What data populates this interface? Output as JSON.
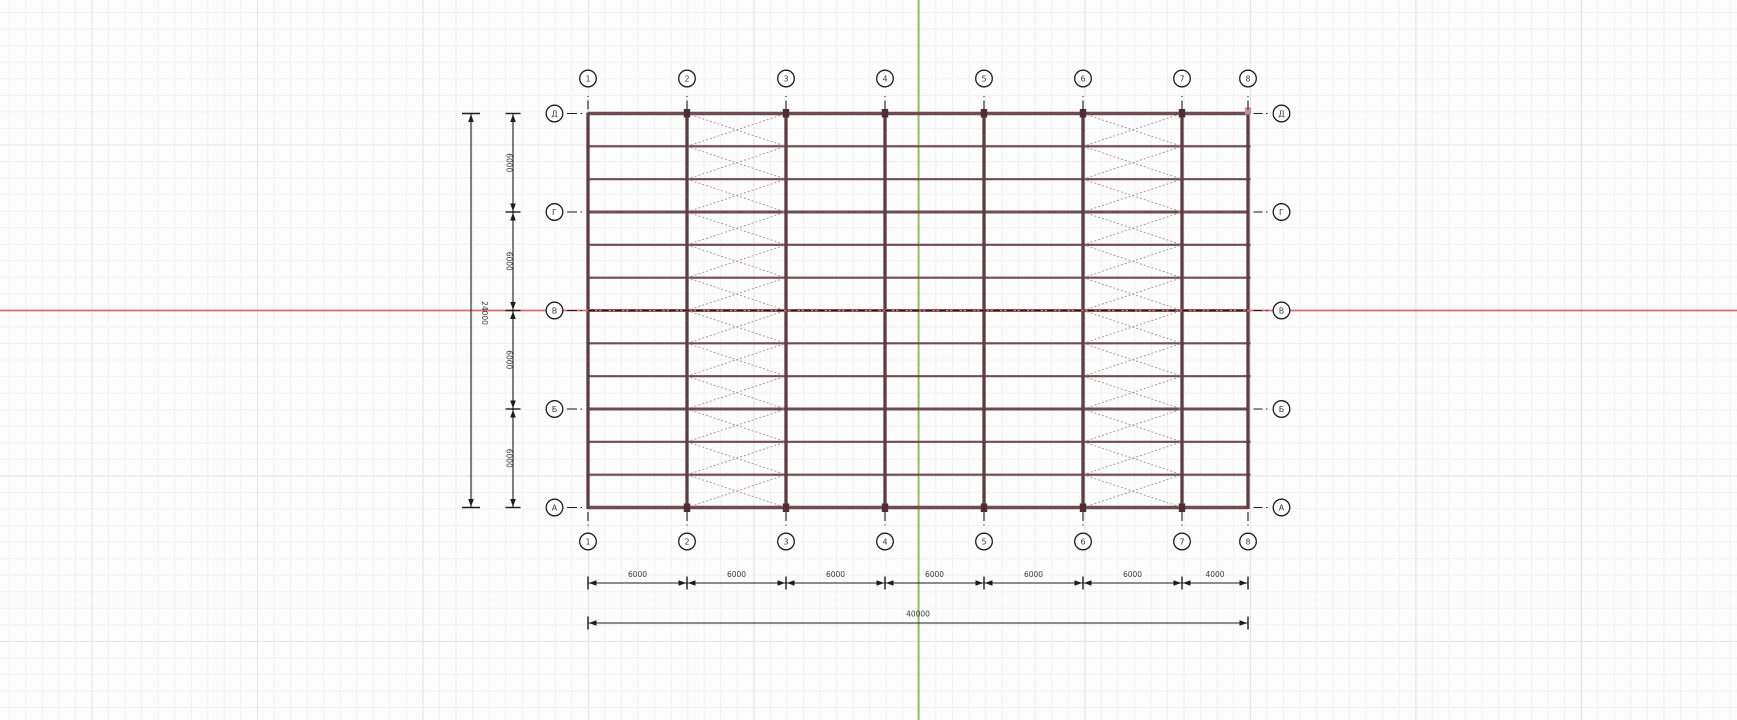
{
  "app": {
    "type": "cad-model-view",
    "description": "Structural steel frame plan view with grid axes and dimensions"
  },
  "canvas": {
    "width": 1737,
    "height": 720,
    "bg_color": "#fcfcfc",
    "grid_minor_color": "#f0f0f1",
    "grid_major_color": "#e4e4e6",
    "grid_minor_step": 16.55,
    "grid_major_step": 165.5,
    "grid_major_offset_x": 91.5,
    "grid_major_offset_y": 144.5
  },
  "construction_lines": {
    "x_axis": {
      "color": "#d96b74",
      "y": 310.5
    },
    "y_axis": {
      "color": "#95b963",
      "x": 918.5
    }
  },
  "structure": {
    "colors": {
      "purlin": "#6e4c52",
      "column": "#5d3d44",
      "marker": "#4c2f36",
      "marker_light": "#c09399",
      "brace": "#ab8c90",
      "grid_highlight": "#1c1c1c"
    },
    "left": 588,
    "right": 1248,
    "top": 113.5,
    "bottom": 507.5,
    "purlin_divisions": 12,
    "grids_x": [
      {
        "label": "1",
        "x": 588
      },
      {
        "label": "2",
        "x": 687
      },
      {
        "label": "3",
        "x": 786
      },
      {
        "label": "4",
        "x": 885
      },
      {
        "label": "5",
        "x": 984
      },
      {
        "label": "6",
        "x": 1083
      },
      {
        "label": "7",
        "x": 1182
      },
      {
        "label": "8",
        "x": 1248
      }
    ],
    "grids_y": [
      {
        "label": "Д",
        "name": "D",
        "y": 113.5
      },
      {
        "label": "Г",
        "name": "G",
        "y": 212
      },
      {
        "label": "В",
        "name": "V",
        "y": 310.5
      },
      {
        "label": "Б",
        "name": "B",
        "y": 409
      },
      {
        "label": "А",
        "name": "A",
        "y": 507.5
      }
    ],
    "braced_bays": [
      [
        "2",
        "3"
      ],
      [
        "6",
        "7"
      ]
    ],
    "column_marker_grids": [
      "2",
      "3",
      "4",
      "5",
      "6",
      "7"
    ],
    "light_marker_grid": "8",
    "highlighted_grid_row": "В"
  },
  "dimensions": {
    "color": "#1c1c1c",
    "text_color": "#3a3a3a",
    "left_total": {
      "value": "24000",
      "line_x": 471,
      "label_x": 482,
      "label_y": 313
    },
    "left_segments": {
      "line_x": 513,
      "label_x": 506.5,
      "values": [
        "6000",
        "6000",
        "6000",
        "6000"
      ]
    },
    "bottom_segments": {
      "line_y": 583,
      "label_y": 577,
      "values": [
        "6000",
        "6000",
        "6000",
        "6000",
        "6000",
        "6000",
        "4000"
      ]
    },
    "bottom_total": {
      "value": "40000",
      "line_y": 623,
      "label_x": 918,
      "label_y": 616.5
    }
  },
  "axis_bubbles": {
    "radius": 8.3,
    "stroke": "#1c1c1c",
    "fill": "#ffffff",
    "text_color": "#3a3a3a",
    "top_cy": 78.5,
    "bottom_cy": 541.5,
    "left_cx": 554.5,
    "right_cx": 1281.5
  }
}
